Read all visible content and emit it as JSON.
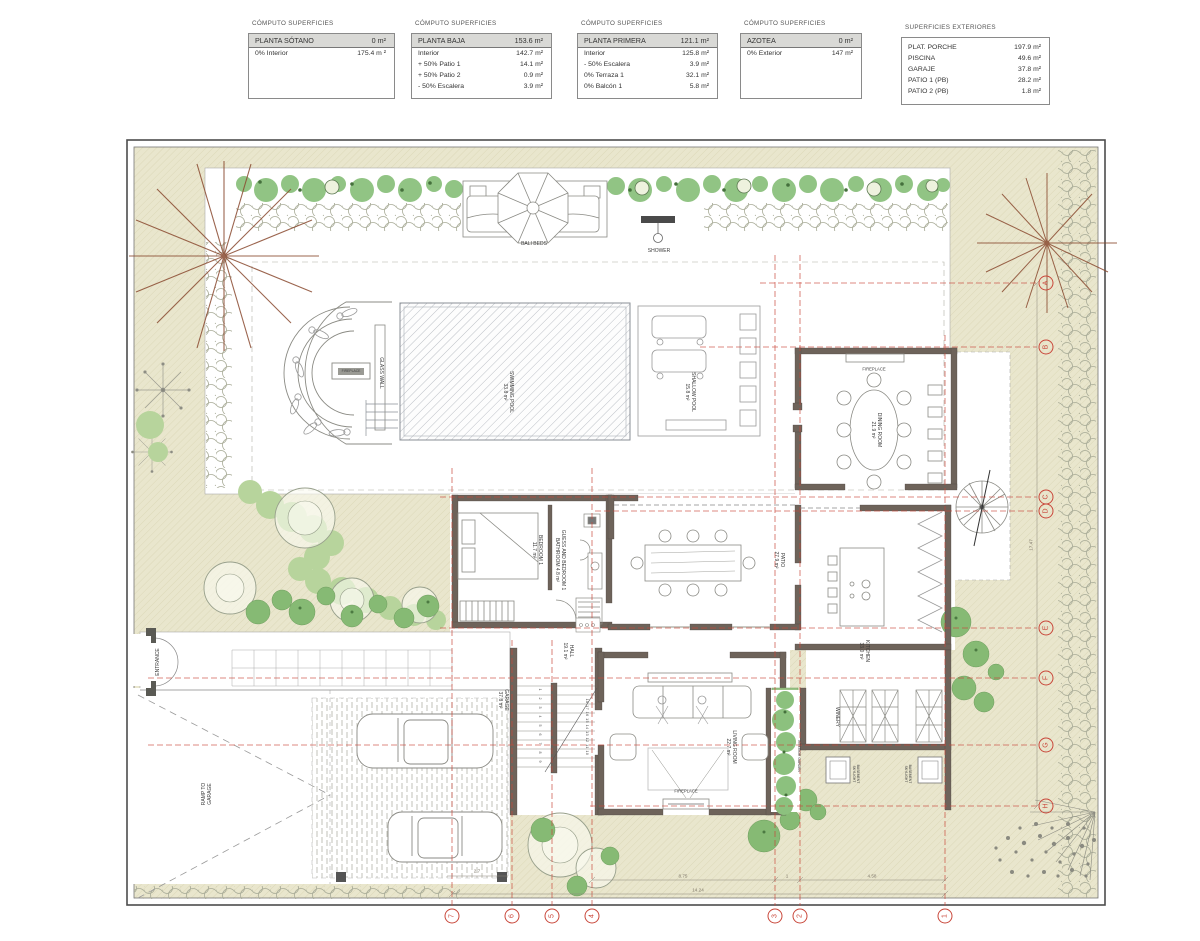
{
  "tables": [
    {
      "caption": "CÓMPUTO SUPERFICIES",
      "header": {
        "label": "PLANTA SÓTANO",
        "value": "0 m²"
      },
      "rows": [
        {
          "label": "0% Interior",
          "value": "175.4 m ²"
        }
      ]
    },
    {
      "caption": "CÓMPUTO SUPERFICIES",
      "header": {
        "label": "PLANTA BAJA",
        "value": "153.6 m²"
      },
      "rows": [
        {
          "label": "Interior",
          "value": "142.7 m²"
        },
        {
          "label": "+ 50% Patio 1",
          "value": "14.1 m²"
        },
        {
          "label": "+ 50% Patio 2",
          "value": "0.9 m²"
        },
        {
          "label": "- 50% Escalera",
          "value": "3.9 m²"
        }
      ]
    },
    {
      "caption": "CÓMPUTO SUPERFICIES",
      "header": {
        "label": "PLANTA PRIMERA",
        "value": "121.1 m²"
      },
      "rows": [
        {
          "label": "Interior",
          "value": "125.8 m²"
        },
        {
          "label": "- 50% Escalera",
          "value": "3.9 m²"
        },
        {
          "label": "0% Terraza 1",
          "value": "32.1 m²"
        },
        {
          "label": "0% Balcón 1",
          "value": "5.8 m²"
        }
      ]
    },
    {
      "caption": "CÓMPUTO SUPERFICIES",
      "header": {
        "label": "AZOTEA",
        "value": "0 m²"
      },
      "rows": [
        {
          "label": "0% Exterior",
          "value": "147 m²"
        }
      ]
    },
    {
      "caption": "SUPERFICIES EXTERIORES",
      "header": null,
      "rows": [
        {
          "label": "PLAT. PORCHE",
          "value": "197.9 m²"
        },
        {
          "label": "PISCINA",
          "value": "49.6 m²"
        },
        {
          "label": "GARAJE",
          "value": "37.8 m²"
        },
        {
          "label": "PATIO 1 (PB)",
          "value": "28.2 m²"
        },
        {
          "label": "PATIO 2 (PB)",
          "value": "1.8 m²"
        }
      ]
    }
  ],
  "plan": {
    "labels": {
      "bali_beds": "BALI BEDS",
      "shower": "SHOWER",
      "glass_wall": "GLASS WALL",
      "swimming_pool": "SWIMMING POOL\n33.8 m²",
      "shallow_pool": "SHALLOW POOL\n15.8 m²",
      "fireplace_lounge": "FIREPLACE",
      "fireplace_dining": "FIREPLACE",
      "fireplace_living": "FIREPLACE",
      "dining_room": "DINING ROOM\n21.9 m²",
      "bedroom_1": "BEDROOM 1\n11.7 m²",
      "guest_bathroom": "GUESS AND BEDROOM 1\nBATHROOM 4.8 m²",
      "patio": "PATIO\n27.9 m²",
      "kitchen": "KITCHEN\n33.0 m²",
      "hall": "HALL\n19.1 m²",
      "garage": "GARAGE\n37.8 m²",
      "living_room": "LIVING ROOM\n22.7 m²",
      "winery": "WINERY",
      "basement_skylight": "BASEMENT\nSKYLIGHT",
      "interior_garden": "INTERIOR GARDEN",
      "entrance": "ENTRANCE",
      "ramp": "RAMP TO\nGARAGE"
    },
    "stairs": {
      "left_numbers": "1 2 3 4 5 6 7 8 9",
      "right_numbers": "18 17 16 15 14 13 12 11 10"
    },
    "grid_letters": [
      "A",
      "B",
      "C",
      "D",
      "E",
      "F",
      "G",
      "H"
    ],
    "grid_numbers": [
      "7",
      "6",
      "5",
      "4",
      "3",
      "2",
      "1"
    ],
    "dimensions": {
      "seg1": "8.75",
      "seg2": "1",
      "seg3": "4.58",
      "total": "14.24",
      "right_total": "17.47",
      "garage": "2.7"
    }
  },
  "colors": {
    "grid_red": "#c9473a",
    "wall": "#6e635a",
    "hedge_green": "#8cc17e",
    "site_beige": "#e9e6cd"
  }
}
